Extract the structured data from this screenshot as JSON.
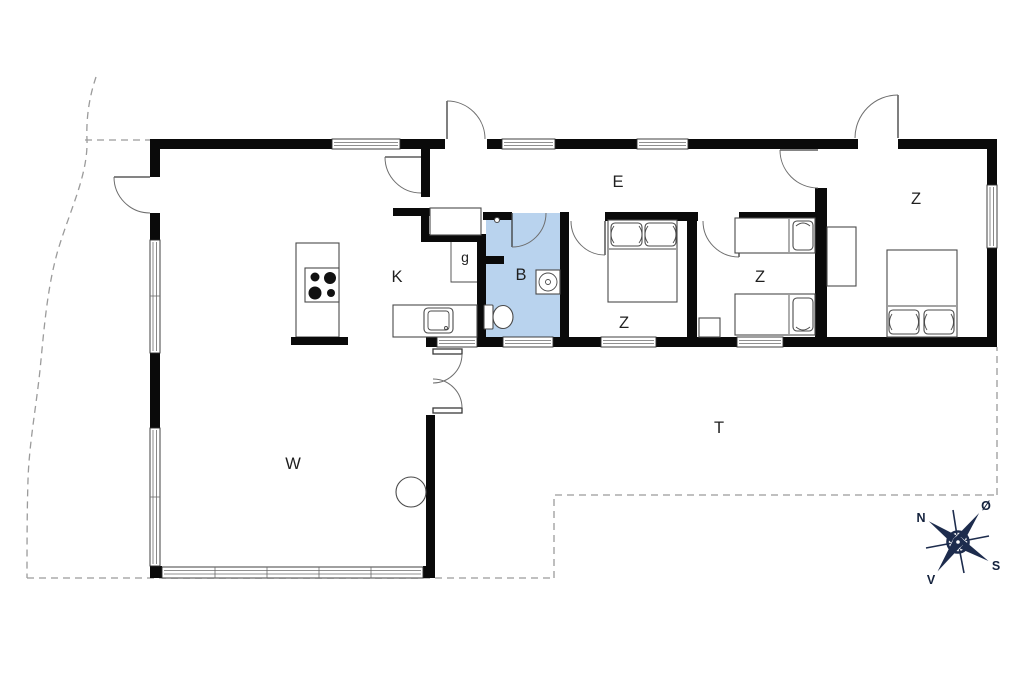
{
  "rooms": [
    {
      "name": "hall",
      "label": "E"
    },
    {
      "name": "kitchen",
      "label": "K"
    },
    {
      "name": "wardrobe-nook",
      "label": "g"
    },
    {
      "name": "bathroom",
      "label": "B"
    },
    {
      "name": "bedroom-middle",
      "label": "Z"
    },
    {
      "name": "bedroom-twin",
      "label": "Z"
    },
    {
      "name": "bedroom-right",
      "label": "Z"
    },
    {
      "name": "living-room",
      "label": "W"
    },
    {
      "name": "terrace",
      "label": "T"
    }
  ],
  "compass": {
    "directions": [
      {
        "name": "north",
        "label": "N"
      },
      {
        "name": "east",
        "label": "Ø"
      },
      {
        "name": "south",
        "label": "S"
      },
      {
        "name": "west",
        "label": "V"
      }
    ]
  },
  "colors": {
    "wall_black": "#0a0a0a",
    "bathroom_fill": "#b9d3ee",
    "boundary_dash": "#9b9b9b",
    "compass_navy": "#1d2c4d"
  }
}
